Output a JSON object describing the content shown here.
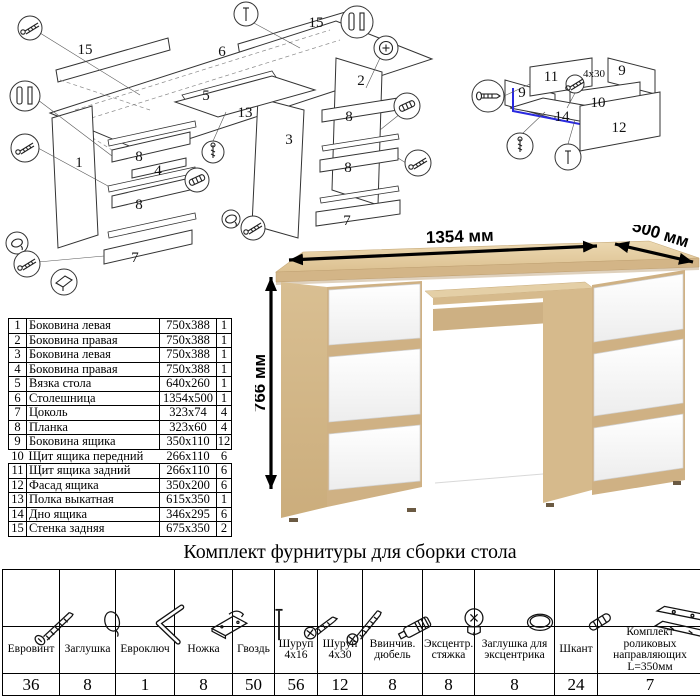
{
  "hardware_table": {
    "title": "Комплект фурнитуры для сборки стола",
    "items": [
      {
        "icon": "confirmat-screw-icon",
        "name": "Евровинт",
        "qty": "36"
      },
      {
        "icon": "cap-icon",
        "name": "Заглушка",
        "qty": "8"
      },
      {
        "icon": "hex-key-icon",
        "name": "Евроключ",
        "qty": "1"
      },
      {
        "icon": "foot-icon",
        "name": "Ножка",
        "qty": "8"
      },
      {
        "icon": "nail-icon",
        "name": "Гвоздь",
        "qty": "50"
      },
      {
        "icon": "screw-4x16-icon",
        "name": "Шуруп\n4x16",
        "qty": "56"
      },
      {
        "icon": "screw-4x30-icon",
        "name": "Шуруп\n4x30",
        "qty": "12"
      },
      {
        "icon": "screw-dowel-icon",
        "name": "Ввинчив.\nдюбель",
        "qty": "8"
      },
      {
        "icon": "cam-lock-icon",
        "name": "Эксцентр.\nстяжка",
        "qty": "8"
      },
      {
        "icon": "cam-cap-icon",
        "name": "Заглушка для\nэксцентрика",
        "qty": "8"
      },
      {
        "icon": "wood-dowel-icon",
        "name": "Шкант",
        "qty": "24"
      },
      {
        "icon": "drawer-slides-icon",
        "name": "Комплект роликовых\nнаправляющих L=350мм",
        "qty": "7"
      }
    ]
  },
  "parts_table": {
    "rows": [
      {
        "num": "1",
        "name": "Боковина левая",
        "size": "750x388",
        "qty": "1"
      },
      {
        "num": "2",
        "name": "Боковина правая",
        "size": "750x388",
        "qty": "1"
      },
      {
        "num": "3",
        "name": "Боковина левая",
        "size": "750x388",
        "qty": "1"
      },
      {
        "num": "4",
        "name": "Боковина правая",
        "size": "750x388",
        "qty": "1"
      },
      {
        "num": "5",
        "name": "Вязка стола",
        "size": "640x260",
        "qty": "1"
      },
      {
        "num": "6",
        "name": "Столешница",
        "size": "1354x500",
        "qty": "1"
      },
      {
        "num": "7",
        "name": "Цоколь",
        "size": "323x74",
        "qty": "4"
      },
      {
        "num": "8",
        "name": "Планка",
        "size": "323x60",
        "qty": "4"
      },
      {
        "num": "9",
        "name": "Боковина ящика",
        "size": "350x110",
        "qty": "12"
      },
      {
        "num": "10",
        "name": "Щит ящика передний",
        "size": "266x110",
        "qty": "6"
      },
      {
        "num": "11",
        "name": "Щит ящика задний",
        "size": "266x110",
        "qty": "6"
      },
      {
        "num": "12",
        "name": "Фасад ящика",
        "size": "350x200",
        "qty": "6"
      },
      {
        "num": "13",
        "name": "Полка выкатная",
        "size": "615x350",
        "qty": "1"
      },
      {
        "num": "14",
        "name": "Дно ящика",
        "size": "346x295",
        "qty": "6"
      },
      {
        "num": "15",
        "name": "Стенка задняя",
        "size": "675x350",
        "qty": "2"
      }
    ]
  },
  "desk_render": {
    "labels": [
      {
        "text": "1354 мм",
        "x": 205,
        "y": 17,
        "rotate": -2,
        "cls": "dim",
        "name": "width-dimension-label"
      },
      {
        "text": "500 мм",
        "x": 404,
        "y": 14,
        "rotate": 17,
        "cls": "dim",
        "name": "depth-dimension-label"
      },
      {
        "text": "766 мм",
        "x": 10,
        "y": 158,
        "rotate": -90,
        "cls": "dim",
        "name": "height-dimension-label"
      }
    ],
    "colors": {
      "oak": "#ddc396",
      "oak_dark": "#cfb184",
      "drawer_white": "#fafafa",
      "highlight_blue": "#2a2ae0",
      "line": "#333333"
    }
  },
  "exploded_main": {
    "labels": [
      {
        "text": "15",
        "x": 85,
        "y": 54
      },
      {
        "text": "6",
        "x": 222,
        "y": 56
      },
      {
        "text": "15",
        "x": 316,
        "y": 27
      },
      {
        "text": "1",
        "x": 79,
        "y": 167
      },
      {
        "text": "2",
        "x": 361,
        "y": 85
      },
      {
        "text": "5",
        "x": 206,
        "y": 100
      },
      {
        "text": "13",
        "x": 245,
        "y": 117
      },
      {
        "text": "3",
        "x": 289,
        "y": 144
      },
      {
        "text": "8",
        "x": 139,
        "y": 161
      },
      {
        "text": "4",
        "x": 158,
        "y": 175
      },
      {
        "text": "8",
        "x": 139,
        "y": 209
      },
      {
        "text": "7",
        "x": 135,
        "y": 262
      },
      {
        "text": "8",
        "x": 349,
        "y": 121
      },
      {
        "text": "8",
        "x": 348,
        "y": 172
      },
      {
        "text": "7",
        "x": 347,
        "y": 225
      }
    ],
    "callouts": [
      {
        "icon": "screw",
        "x": 30,
        "y": 28,
        "r": 12
      },
      {
        "icon": "pins",
        "x": 25,
        "y": 96,
        "r": 15
      },
      {
        "icon": "screw",
        "x": 25,
        "y": 148,
        "r": 14
      },
      {
        "icon": "cap",
        "x": 17,
        "y": 243,
        "r": 11
      },
      {
        "icon": "screw",
        "x": 27,
        "y": 264,
        "r": 13
      },
      {
        "icon": "foot",
        "x": 64,
        "y": 282,
        "r": 13
      },
      {
        "icon": "nail",
        "x": 246,
        "y": 14,
        "r": 12
      },
      {
        "icon": "pins",
        "x": 357,
        "y": 22,
        "r": 16
      },
      {
        "icon": "cam",
        "x": 386,
        "y": 48,
        "r": 12
      },
      {
        "icon": "dowel",
        "x": 407,
        "y": 106,
        "r": 13
      },
      {
        "icon": "screw",
        "x": 418,
        "y": 163,
        "r": 13
      },
      {
        "icon": "cap",
        "x": 231,
        "y": 219,
        "r": 9
      },
      {
        "icon": "screw",
        "x": 253,
        "y": 228,
        "r": 12
      },
      {
        "icon": "dowel",
        "x": 197,
        "y": 180,
        "r": 12
      },
      {
        "icon": "screw-v",
        "x": 213,
        "y": 152,
        "r": 11
      }
    ]
  },
  "exploded_drawer": {
    "labels": [
      {
        "text": "11",
        "x": 96,
        "y": 81
      },
      {
        "text": "9",
        "x": 167,
        "y": 75
      },
      {
        "text": "9",
        "x": 67,
        "y": 97
      },
      {
        "text": "10",
        "x": 143,
        "y": 107
      },
      {
        "text": "14",
        "x": 107,
        "y": 121
      },
      {
        "text": "12",
        "x": 164,
        "y": 132
      },
      {
        "text": "4x30",
        "x": 139,
        "y": 77,
        "cls": "dlabel-small",
        "name": "screw-size-note"
      }
    ],
    "callouts": [
      {
        "icon": "confirmat",
        "x": 33,
        "y": 96,
        "r": 16
      },
      {
        "icon": "screw-v",
        "x": 65,
        "y": 146,
        "r": 13
      },
      {
        "icon": "nail",
        "x": 113,
        "y": 157,
        "r": 13
      },
      {
        "icon": "screw",
        "x": 120,
        "y": 84,
        "r": 9
      }
    ]
  }
}
